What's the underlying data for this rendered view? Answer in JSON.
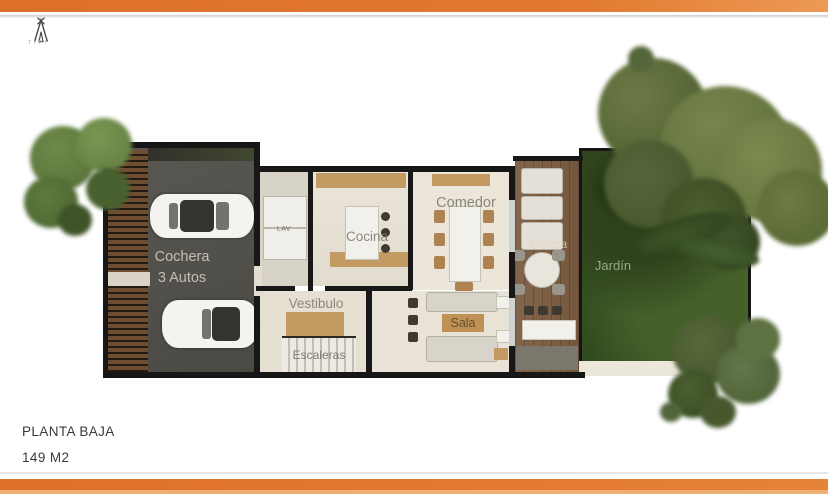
{
  "brand": {
    "name": "TIPI",
    "icon": "teepee-icon"
  },
  "title_block": {
    "floor_label": "PLANTA BAJA",
    "area_label": "149 M2"
  },
  "theme": {
    "accent_orange": "#E0752B",
    "wall_black": "#171717",
    "garden_green": "#3B5124",
    "floor_cream": "#E9E3D8",
    "wood_tan": "#C49A66",
    "deck_brown": "#7D5F43",
    "garage_gray": "#55534C",
    "label_gray": "#8B867B"
  },
  "plan": {
    "rooms": {
      "cochera": {
        "label": "Cochera",
        "label2": "3 Autos"
      },
      "lav": {
        "label": "LAV"
      },
      "cocina": {
        "label": "Cocina"
      },
      "comedor": {
        "label": "Comedor"
      },
      "vestibulo": {
        "label": "Vestibulo"
      },
      "escaleras": {
        "label": "Escaleras"
      },
      "sala": {
        "label": "Sala"
      },
      "terraza": {
        "label": "Terraza"
      },
      "jardin": {
        "label": "Jardín"
      }
    }
  }
}
